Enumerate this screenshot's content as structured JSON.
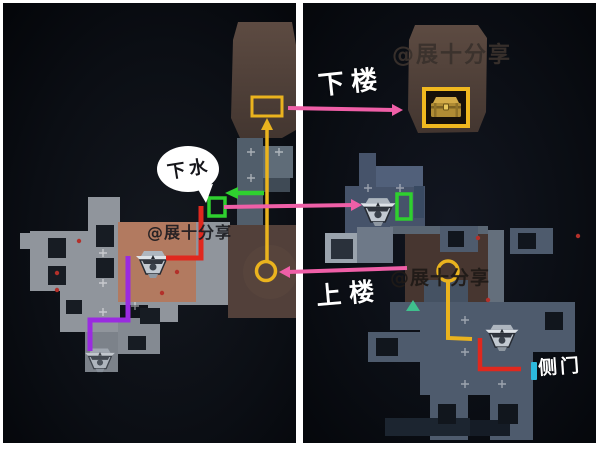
{
  "left_map": {
    "speech_bubble_text": "下水",
    "watermark": "@展十分享"
  },
  "right_map": {
    "label_downstairs": "下楼",
    "label_upstairs": "上楼",
    "label_side_door": "侧门",
    "watermark_top": "@展十分享",
    "watermark_middle": "@展十分享"
  },
  "colors": {
    "arrow_pink": "#ef5fa7",
    "route_yellow": "#eab31e",
    "route_red": "#e0281e",
    "route_purple": "#9a2be0",
    "highlight_green": "#2fd02f",
    "side_door_cyan": "#2cb9dd",
    "room_brown": "#4a3831",
    "room_salmon": "#b27a60",
    "tile_gray_left": "#90959c",
    "tile_gray_right": "#4e5b6d",
    "divider_white": "#ffffff",
    "background_dark": "#0a0c11"
  }
}
